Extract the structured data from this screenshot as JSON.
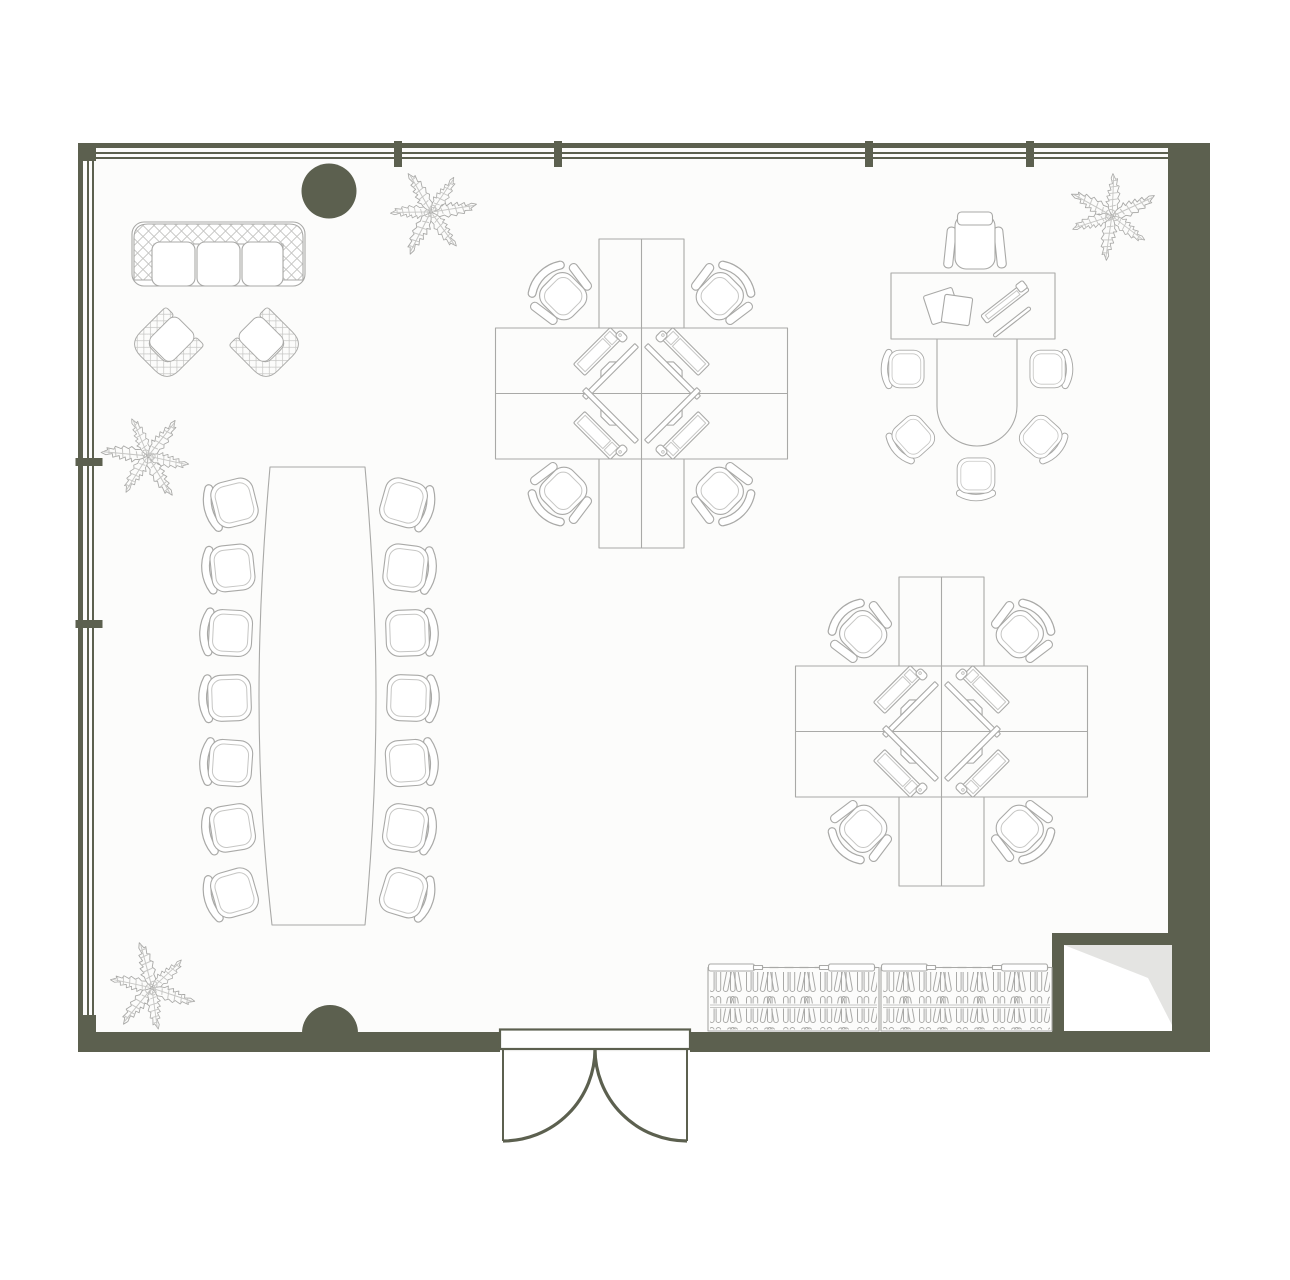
{
  "page": {
    "title": "Office floor plan",
    "background": "#ffffff"
  },
  "palette": {
    "wall": "#5c604f",
    "furniture_line": "#a9a9a7",
    "furniture_line_light": "#c6c6c4",
    "room_fill": "#fcfcfb",
    "shade": "#e4e4e2",
    "white": "#ffffff"
  },
  "room": {
    "walls": {
      "top": "window-band",
      "left": "window-band",
      "right": "solid",
      "bottom": "solid"
    },
    "windows": {
      "top_panes": 5,
      "top_mullions": 4,
      "left_panes": 3,
      "left_mullions": 2
    },
    "door": {
      "type": "double-swing",
      "location": "bottom-center",
      "leaves": 2
    },
    "columns": [
      {
        "shape": "circle",
        "location": "top-left"
      },
      {
        "shape": "half-circle",
        "location": "bottom-left-of-door"
      }
    ],
    "shaft": {
      "location": "bottom-right-corner",
      "shading": "diagonal"
    }
  },
  "furniture": {
    "lounge": {
      "sofa_seats": 3,
      "armchairs": 2
    },
    "conference": {
      "table_shape": "barrel",
      "chairs": 14
    },
    "workstation_clusters": [
      {
        "desks": 4,
        "chairs": 4,
        "monitors": 4,
        "keyboards": 4,
        "mice": 4
      },
      {
        "desks": 4,
        "chairs": 4,
        "monitors": 4,
        "keyboards": 4,
        "mice": 4
      }
    ],
    "executive": {
      "desks": 1,
      "task_chairs": 1,
      "meeting_table_shape": "u-shape",
      "guest_chairs": 5,
      "paper_stacks": 2,
      "desk_accessories": 2
    },
    "storage": {
      "bookcases": 2,
      "shelf_rows_per_case": 2,
      "handles_per_case": 2
    },
    "plants": 4
  }
}
